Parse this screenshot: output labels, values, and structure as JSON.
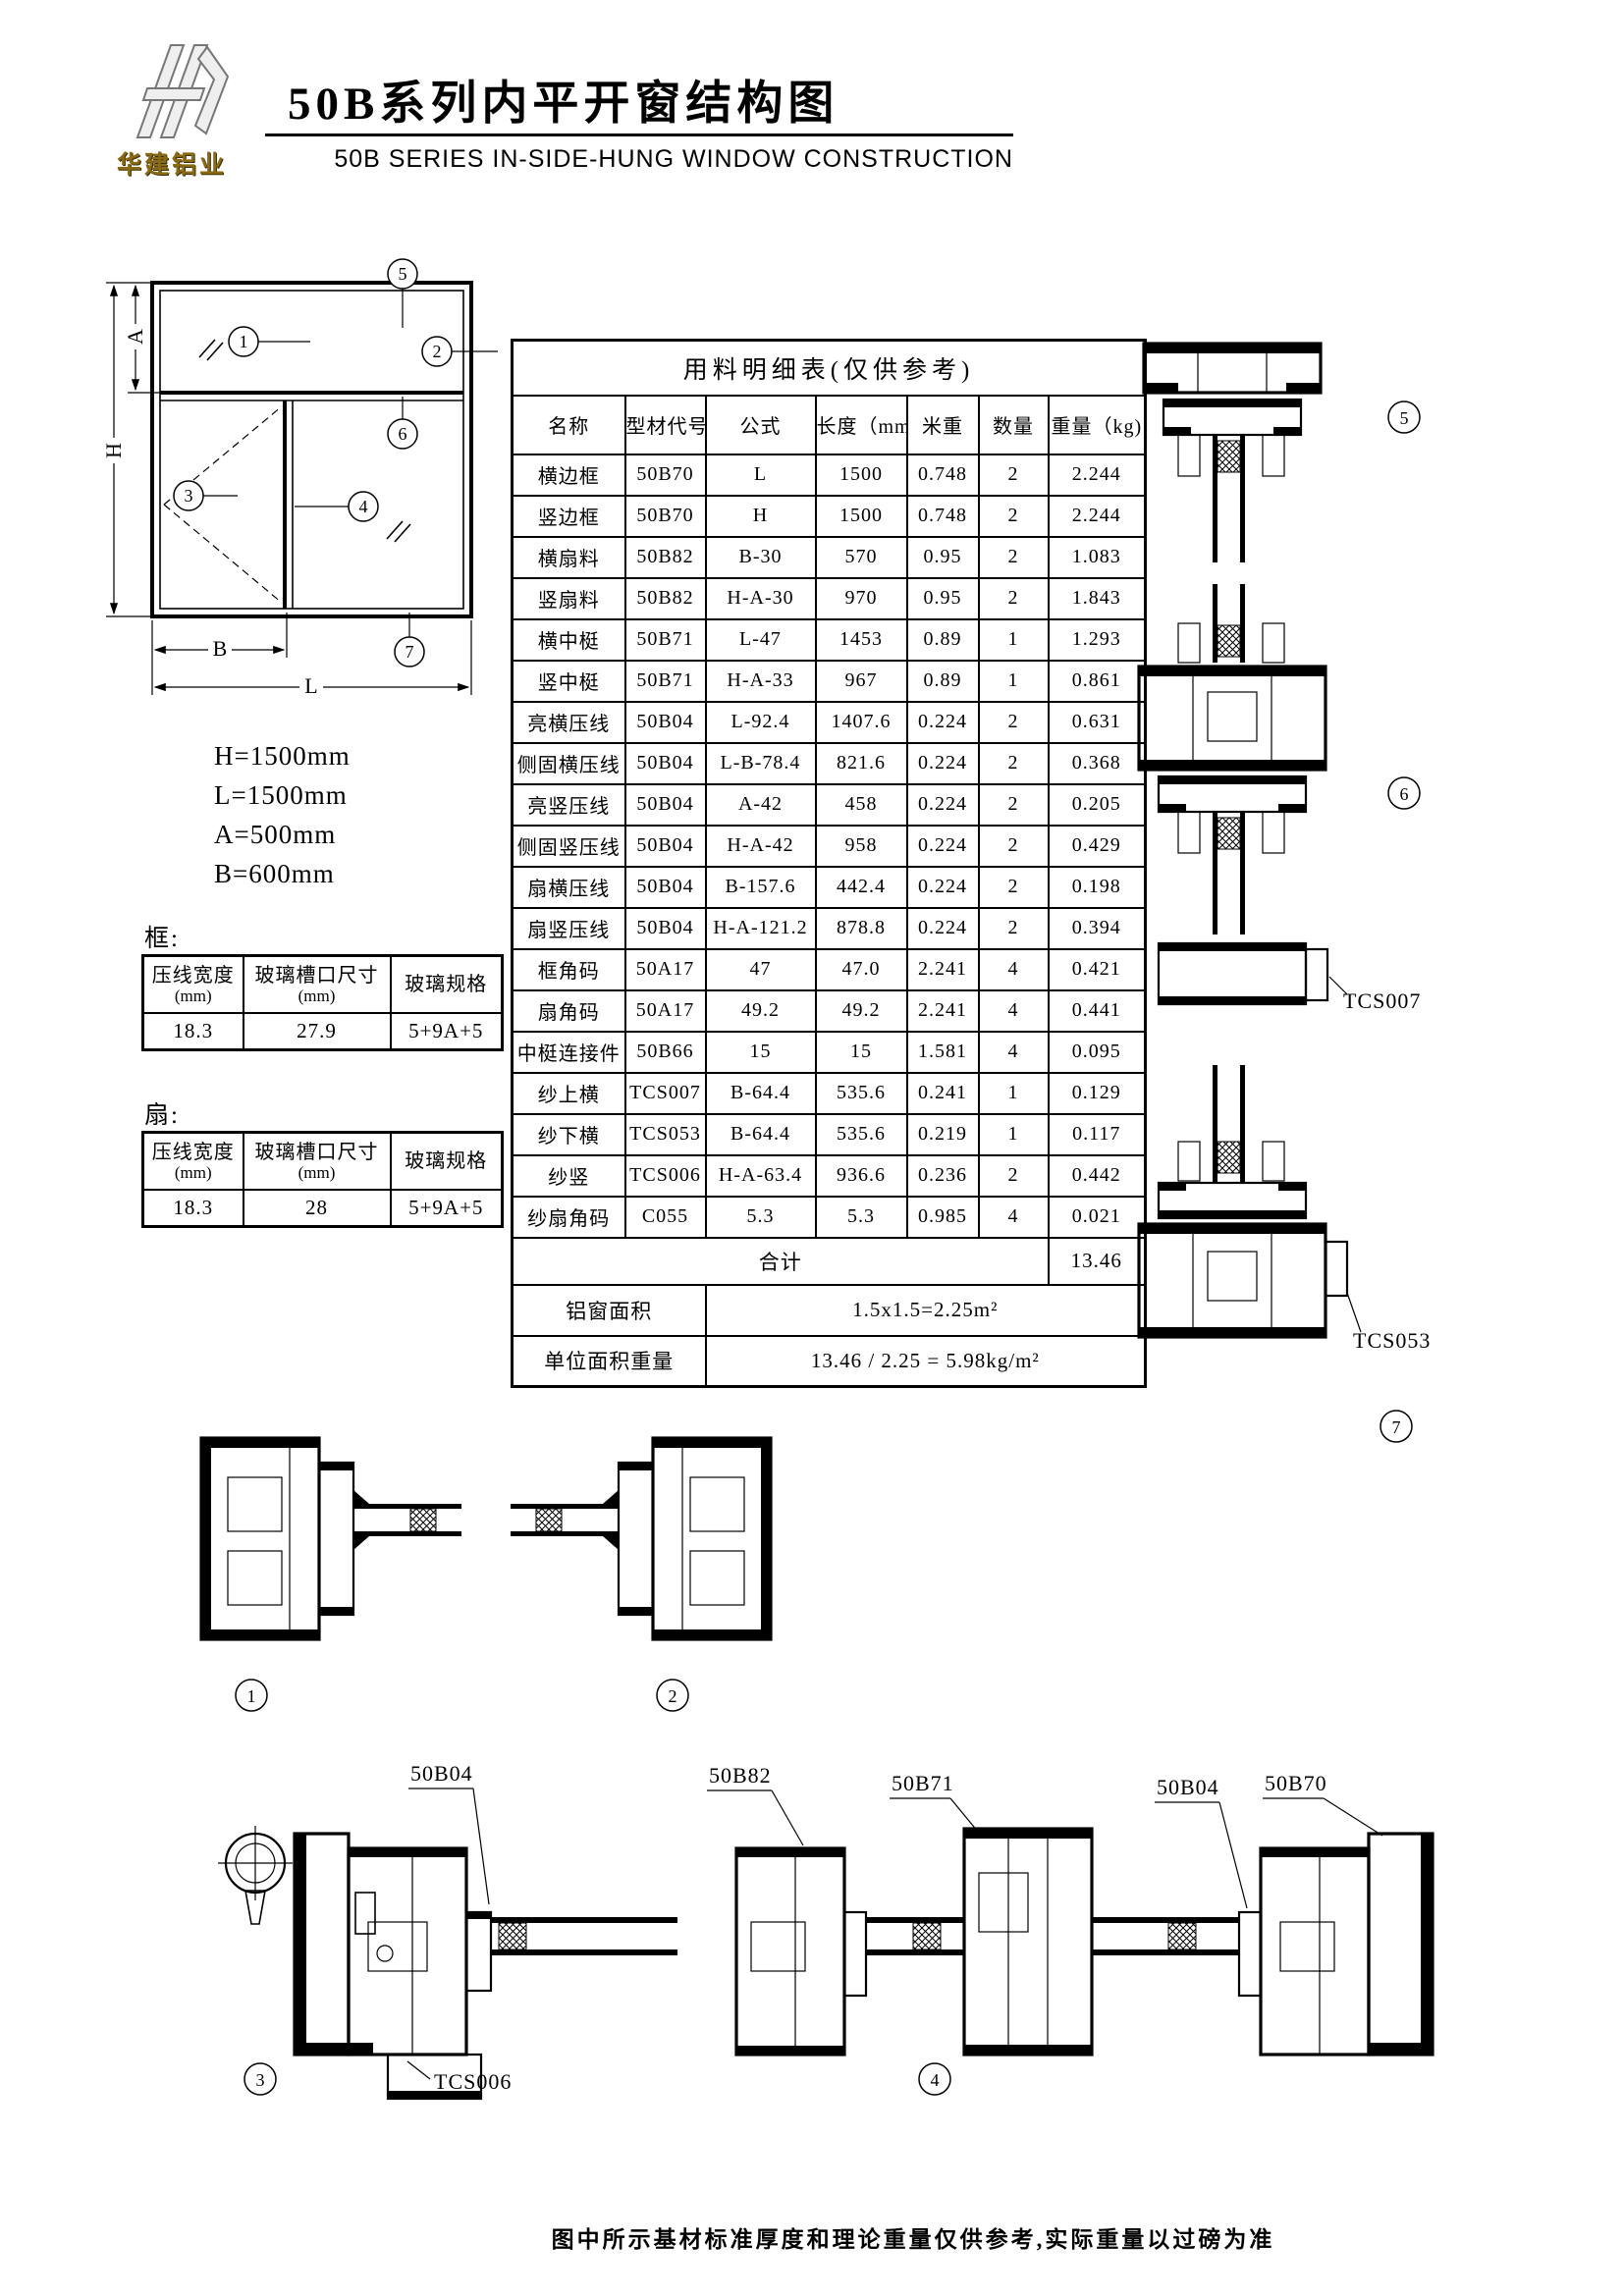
{
  "header": {
    "logo_text": "华建铝业",
    "title_cn": "50B系列内平开窗结构图",
    "title_en": "50B SERIES IN-SIDE-HUNG WINDOW CONSTRUCTION"
  },
  "elevation": {
    "callouts": {
      "c1": "1",
      "c2": "2",
      "c3": "3",
      "c4": "4",
      "c5": "5",
      "c6": "6",
      "c7": "7"
    },
    "dim_letters": {
      "H": "H",
      "L": "L",
      "A": "A",
      "B": "B"
    },
    "dim_text": [
      "H=1500mm",
      "L=1500mm",
      "A=500mm",
      "B=600mm"
    ]
  },
  "frame_table": {
    "label": "框:",
    "col1": "压线宽度",
    "col1_unit": "(mm)",
    "col2": "玻璃槽口尺寸",
    "col2_unit": "(mm)",
    "col3": "玻璃规格",
    "values": [
      "18.3",
      "27.9",
      "5+9A+5"
    ]
  },
  "sash_table": {
    "label": "扇:",
    "col1": "压线宽度",
    "col1_unit": "(mm)",
    "col2": "玻璃槽口尺寸",
    "col2_unit": "(mm)",
    "col3": "玻璃规格",
    "values": [
      "18.3",
      "28",
      "5+9A+5"
    ]
  },
  "bom": {
    "title": "用料明细表(仅供参考)",
    "headers": [
      "名称",
      "型材代号",
      "公式",
      "长度（mm)",
      "米重",
      "数量",
      "重量（kg)"
    ],
    "rows": [
      [
        "横边框",
        "50B70",
        "L",
        "1500",
        "0.748",
        "2",
        "2.244"
      ],
      [
        "竖边框",
        "50B70",
        "H",
        "1500",
        "0.748",
        "2",
        "2.244"
      ],
      [
        "横扇料",
        "50B82",
        "B-30",
        "570",
        "0.95",
        "2",
        "1.083"
      ],
      [
        "竖扇料",
        "50B82",
        "H-A-30",
        "970",
        "0.95",
        "2",
        "1.843"
      ],
      [
        "横中梃",
        "50B71",
        "L-47",
        "1453",
        "0.89",
        "1",
        "1.293"
      ],
      [
        "竖中梃",
        "50B71",
        "H-A-33",
        "967",
        "0.89",
        "1",
        "0.861"
      ],
      [
        "亮横压线",
        "50B04",
        "L-92.4",
        "1407.6",
        "0.224",
        "2",
        "0.631"
      ],
      [
        "侧固横压线",
        "50B04",
        "L-B-78.4",
        "821.6",
        "0.224",
        "2",
        "0.368"
      ],
      [
        "亮竖压线",
        "50B04",
        "A-42",
        "458",
        "0.224",
        "2",
        "0.205"
      ],
      [
        "侧固竖压线",
        "50B04",
        "H-A-42",
        "958",
        "0.224",
        "2",
        "0.429"
      ],
      [
        "扇横压线",
        "50B04",
        "B-157.6",
        "442.4",
        "0.224",
        "2",
        "0.198"
      ],
      [
        "扇竖压线",
        "50B04",
        "H-A-121.2",
        "878.8",
        "0.224",
        "2",
        "0.394"
      ],
      [
        "框角码",
        "50A17",
        "47",
        "47.0",
        "2.241",
        "4",
        "0.421"
      ],
      [
        "扇角码",
        "50A17",
        "49.2",
        "49.2",
        "2.241",
        "4",
        "0.441"
      ],
      [
        "中梃连接件",
        "50B66",
        "15",
        "15",
        "1.581",
        "4",
        "0.095"
      ],
      [
        "纱上横",
        "TCS007",
        "B-64.4",
        "535.6",
        "0.241",
        "1",
        "0.129"
      ],
      [
        "纱下横",
        "TCS053",
        "B-64.4",
        "535.6",
        "0.219",
        "1",
        "0.117"
      ],
      [
        "纱竖",
        "TCS006",
        "H-A-63.4",
        "936.6",
        "0.236",
        "2",
        "0.442"
      ],
      [
        "纱扇角码",
        "C055",
        "5.3",
        "5.3",
        "0.985",
        "4",
        "0.021"
      ]
    ],
    "total_label": "合计",
    "total_value": "13.46",
    "area_label": "铝窗面积",
    "area_value": "1.5x1.5=2.25m²",
    "unit_weight_label": "单位面积重量",
    "unit_weight_value": "13.46 / 2.25 = 5.98kg/m²"
  },
  "sections": {
    "middle_callouts": [
      "1",
      "2"
    ],
    "bottom_callouts": [
      "3",
      "4"
    ],
    "right_callouts": [
      "5",
      "6",
      "7"
    ],
    "bottom_labels": [
      "50B04",
      "50B82",
      "50B71",
      "50B04",
      "50B70"
    ],
    "tcs006": "TCS006",
    "tcs007": "TCS007",
    "tcs053": "TCS053"
  },
  "footer": {
    "note": "图中所示基材标准厚度和理论重量仅供参考,实际重量以过磅为准"
  }
}
